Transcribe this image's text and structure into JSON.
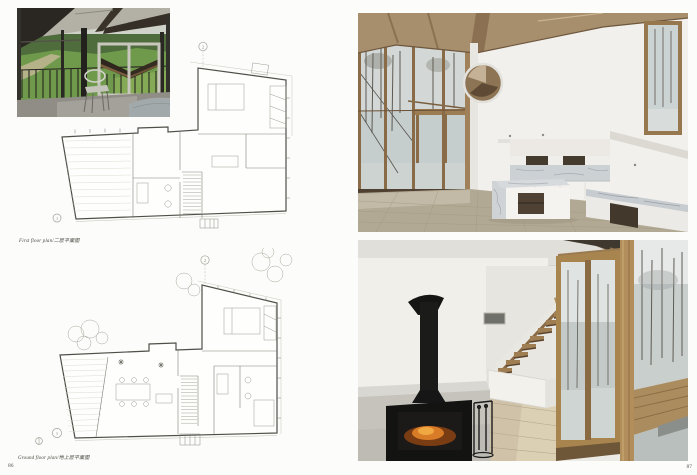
{
  "page": {
    "left_number": "86",
    "right_number": "87"
  },
  "captions": {
    "first_floor": "First floor plan/二层平面图",
    "ground_floor": "Ground floor plan/地上层平面图"
  },
  "plans": {
    "first_floor": {
      "datum_top": "2",
      "datum_bottom": "1"
    },
    "ground_floor": {
      "datum_top": "2",
      "datum_bottom": "1"
    }
  },
  "colors": {
    "paper": "#fcfcfa",
    "plan_outline": "#4f4f49",
    "plan_detail": "#7d7d76",
    "lawn_green": "#6f9a4c",
    "ceiling_wood": "#a78e6c",
    "window_frame_wood": "#a0815a",
    "marble": "#ccd1d4",
    "stove_black": "#151514",
    "fire_glow": "#d97c28",
    "snow": "#c6cdcd",
    "caption_text": "#45453f"
  }
}
